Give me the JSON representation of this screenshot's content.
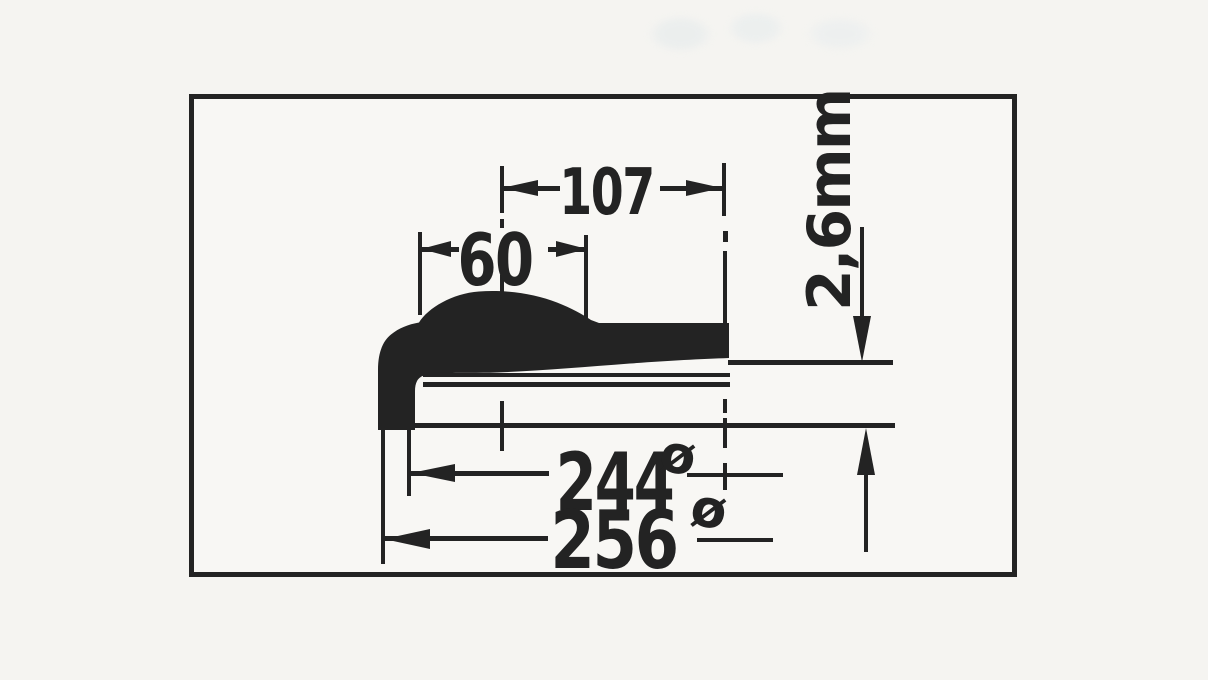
{
  "drawing": {
    "type": "technical-cross-section",
    "dims": {
      "d107": "107",
      "d60": "60",
      "thickness": "2,6mm",
      "d244": "244",
      "d256": "256",
      "dia": "ø"
    },
    "colors": {
      "ink": "#232323",
      "paper": "#f5f4f1"
    }
  }
}
